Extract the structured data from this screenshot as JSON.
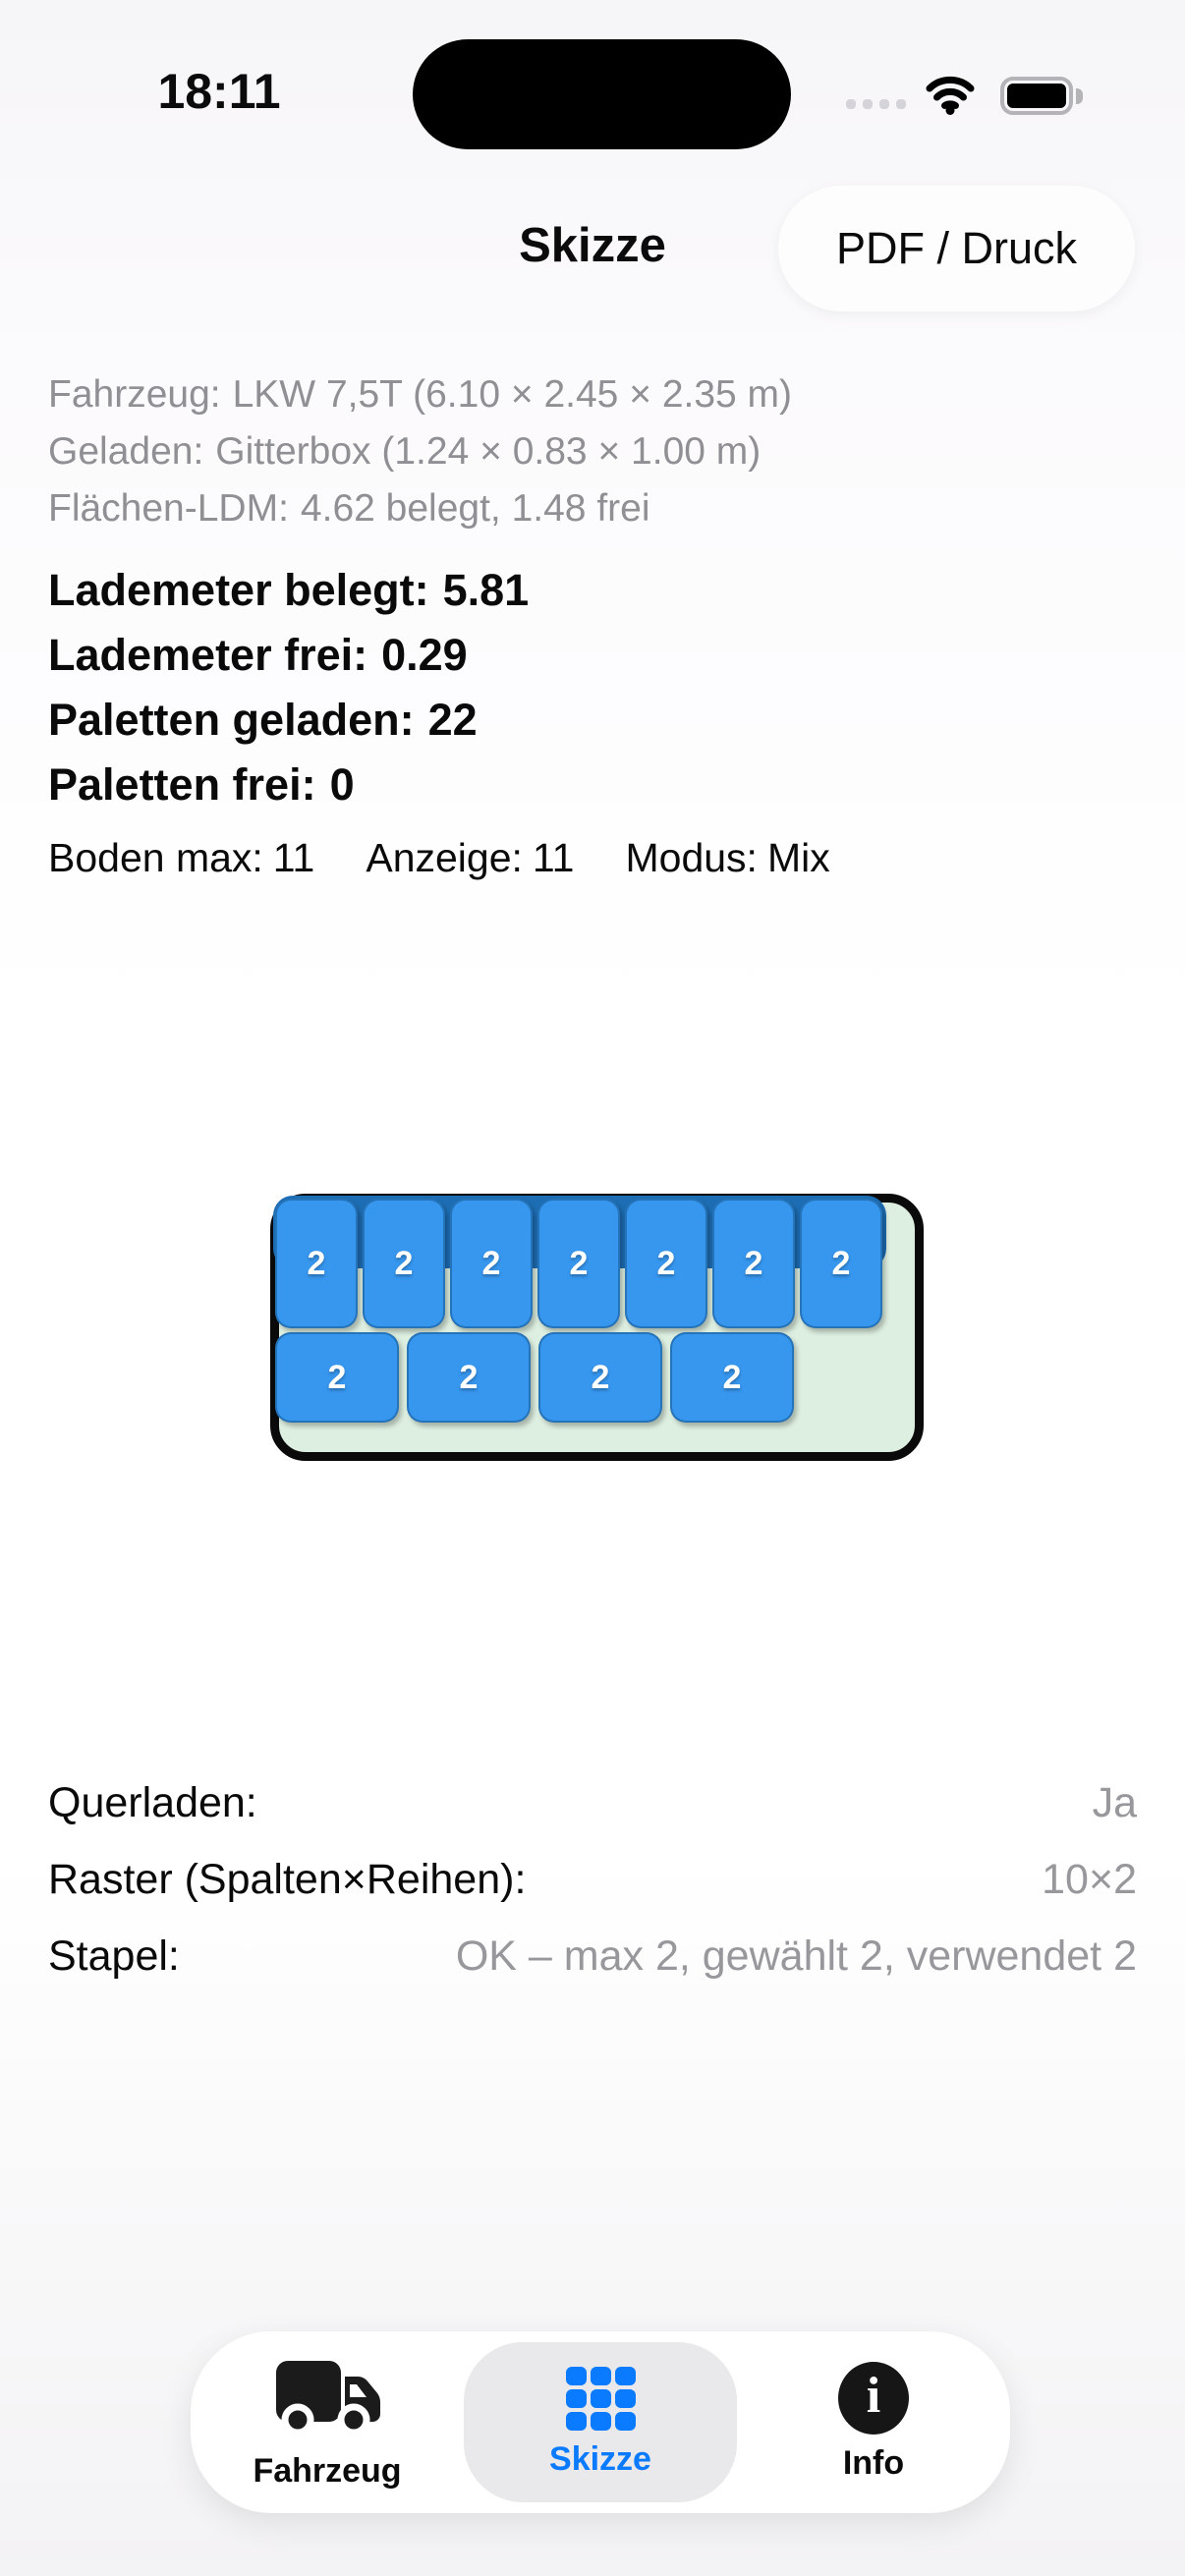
{
  "status_bar": {
    "time": "18:11",
    "icons": [
      "cellular-dots",
      "wifi",
      "battery-full"
    ]
  },
  "header": {
    "title": "Skizze",
    "pdf_button_label": "PDF / Druck"
  },
  "summary": [
    {
      "label": "Fahrzeug:",
      "value": "LKW 7,5T (6.10 × 2.45 × 2.35 m)"
    },
    {
      "label": "Geladen:",
      "value": "Gitterbox (1.24 × 0.83 × 1.00 m)"
    },
    {
      "label": "Flächen-LDM:",
      "value": "4.62 belegt, 1.48 frei"
    }
  ],
  "stats": [
    {
      "label": "Lademeter belegt:",
      "value": "5.81"
    },
    {
      "label": "Lademeter frei:",
      "value": "0.29"
    },
    {
      "label": "Paletten geladen:",
      "value": "22"
    },
    {
      "label": "Paletten frei:",
      "value": "0"
    }
  ],
  "meta": [
    {
      "label": "Boden max:",
      "value": "11"
    },
    {
      "label": "Anzeige:",
      "value": "11"
    },
    {
      "label": "Modus:",
      "value": "Mix"
    }
  ],
  "diagram": {
    "row1": [
      "2",
      "2",
      "2",
      "2",
      "2",
      "2",
      "2"
    ],
    "row2": [
      "2",
      "2",
      "2",
      "2"
    ],
    "colors": {
      "pallet_fill": "#3797ef",
      "pallet_edge": "#17568c",
      "stack_back": "#1d6db4",
      "bed_fill": "#ddefe0",
      "bed_outline": "#0a0a0a"
    }
  },
  "details": [
    {
      "label": "Querladen:",
      "value": "Ja"
    },
    {
      "label": "Raster (Spalten×Reihen):",
      "value": "10×2"
    },
    {
      "label": "Stapel:",
      "value": "OK – max 2, gewählt 2, verwendet 2"
    }
  ],
  "tab_bar": {
    "active_color": "#0a7aff",
    "tabs": [
      {
        "label": "Fahrzeug",
        "icon": "truck-icon",
        "active": false
      },
      {
        "label": "Skizze",
        "icon": "grid-icon",
        "active": true
      },
      {
        "label": "Info",
        "icon": "info-icon",
        "active": false
      }
    ]
  }
}
